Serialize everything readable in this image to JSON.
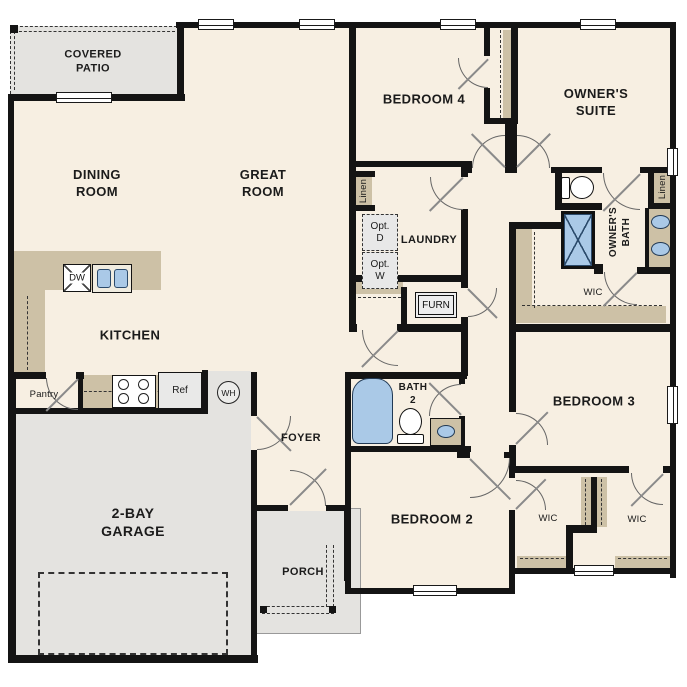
{
  "plan_title": "Single-story floor plan",
  "colors": {
    "wall": "#141414",
    "floor": "#f7efe2",
    "hard_surface": "#e4e3e0",
    "cabinet_tan": "#cdc1a6",
    "plumbing_blue": "#aac9e7",
    "door_arc": "#6e6e6e"
  },
  "rooms": {
    "covered_patio": "COVERED\nPATIO",
    "dining": "DINING\nROOM",
    "great": "GREAT\nROOM",
    "bedroom4": "BEDROOM 4",
    "owners_suite": "OWNER'S\nSUITE",
    "laundry": "LAUNDRY",
    "kitchen": "KITCHEN",
    "owners_bath": "OWNER'S\nBATH",
    "owners_wic": "WIC",
    "foyer": "FOYER",
    "pantry": "Pantry",
    "garage": "2-BAY\nGARAGE",
    "porch": "PORCH",
    "bedroom2": "BEDROOM 2",
    "bath2": "BATH\n2",
    "bedroom3": "BEDROOM 3",
    "wic_left": "WIC",
    "wic_right": "WIC"
  },
  "fixtures": {
    "dishwasher": "DW",
    "refrigerator": "Ref",
    "water_heater": "WH",
    "furnace": "FURN",
    "optional_dryer": "Opt.\nD",
    "optional_washer": "Opt.\nW",
    "linen_hall": "Linen",
    "linen_owners": "Linen"
  }
}
